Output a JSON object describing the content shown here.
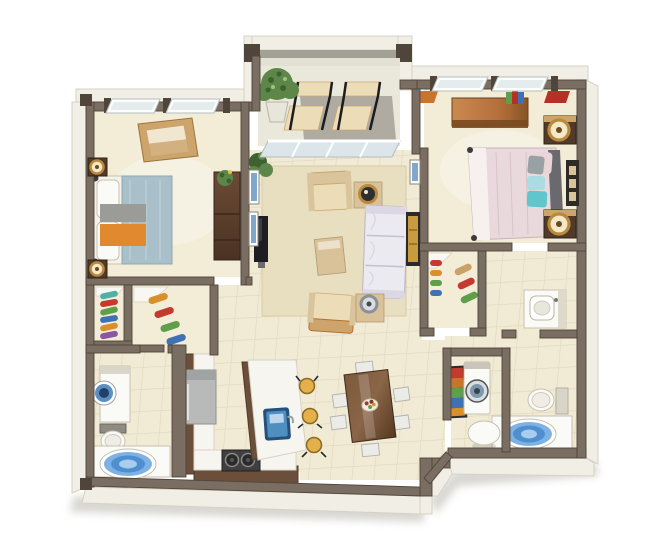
{
  "meta": {
    "kind": "3d-apartment-floor-plan-rendering",
    "background": "#ffffff"
  },
  "palette": {
    "bg": "#ffffff",
    "shadow": "#cdccc6",
    "wallTop": "#7a6d61",
    "wallEdge": "#50453b",
    "outerFace": "#f1eee5",
    "outerEdge": "#d6d1c2",
    "balconyCap": "#a3a096",
    "floorCarpet": "#f3ecd7",
    "floorTile": "#f1ead4",
    "floorTileLine": "#e0d7bb",
    "balconyFloor": "#eae7db",
    "balconyMat": "#a8a49a",
    "glass": "#dce6ea",
    "glassFrame": "#b4bec2",
    "rug": "#e8dec0",
    "wood": "#6b4f3b",
    "woodDark": "#513a29",
    "woodLight": "#cda46c",
    "counter": "#f7f5f0",
    "fridge": "#b7bab9",
    "stove": "#3f3f3f",
    "sinkBlue": "#4f8fc0",
    "sinkBlueDeep": "#24507c",
    "stoolYellow": "#e3b04b",
    "bedBlue": "#a9c0cb",
    "bedBlush": "#ead9dc",
    "headboard": "#6a6a6e",
    "pillowTeal": "#5fc6ce",
    "pillowTealLight": "#a9dde2",
    "pillowGray": "#9aa1a5",
    "throwOrange": "#e0892f",
    "throwGray": "#9b9b97",
    "sofaWhite": "#eceaf1",
    "chairBeige": "#ecdcb8",
    "chairFrame": "#b5702c",
    "tableTan": "#d9c299",
    "walnut": "#6e4c33",
    "chairWhite": "#ebebe7",
    "fixtureWhite": "#fafaf7",
    "fixtureLine": "#c6c1b2",
    "tubBlue1": "#4f8fd0",
    "tubBlue2": "#7fb2e4",
    "tubBlue3": "#a9cdee",
    "plantGreen": "#5d8748",
    "plantDark": "#3f6132",
    "lampGold": "#b98a3e",
    "tvBlack": "#1e1e22",
    "artGold": "#c99a3f",
    "artBlue": "#7fa8cc",
    "artRed": "#b43125",
    "artOrange": "#c9742e",
    "clothesRed": "#c23b2e",
    "clothesGold": "#d98f2b",
    "clothesGreen": "#5f9e4a",
    "clothesBlue": "#3f72b5",
    "clothesTeal": "#4fb0a8",
    "clothesPurple": "#8a56a0"
  },
  "unit": {
    "rooms": [
      {
        "name": "bedroom-2",
        "furniture": [
          "double-bed-blue",
          "nightstand-with-lamp",
          "nightstand-with-lamp",
          "open-storage-chest",
          "wardrobe-with-plant",
          "two-windows"
        ]
      },
      {
        "name": "hall-closets",
        "furniture": [
          "closet-shelf-with-clothes",
          "closet-rod-with-clothes"
        ]
      },
      {
        "name": "bathroom-2",
        "furniture": [
          "basin-cabinet",
          "toilet",
          "round-tub"
        ]
      },
      {
        "name": "balcony",
        "furniture": [
          "potted-tree",
          "patio-chair",
          "patio-chair",
          "floor-mat",
          "sliding-glass-door"
        ]
      },
      {
        "name": "living-room",
        "furniture": [
          "sofa",
          "armchair",
          "armchair",
          "coffee-table",
          "end-table-with-lamp",
          "side-table-with-lamp",
          "tv",
          "area-rug",
          "plant",
          "wall-art"
        ]
      },
      {
        "name": "master-bedroom",
        "furniture": [
          "double-bed-blush",
          "nightstand-with-lamp",
          "nightstand-with-lamp",
          "dresser-with-books",
          "two-windows",
          "wall-art",
          "accent-mats"
        ]
      },
      {
        "name": "master-closet",
        "furniture": [
          "shelf",
          "clothes-on-rods"
        ]
      },
      {
        "name": "master-bathroom",
        "furniture": [
          "vanity-sink",
          "toilet",
          "round-tub"
        ]
      },
      {
        "name": "laundry-closet",
        "furniture": [
          "front-load-washer",
          "artwork-panel"
        ]
      },
      {
        "name": "kitchen",
        "furniture": [
          "refrigerator",
          "l-shaped-counter",
          "cooktop",
          "island-with-sink",
          "bar-stool",
          "bar-stool",
          "bar-stool"
        ]
      },
      {
        "name": "dining-area",
        "furniture": [
          "dining-table",
          "six-chairs",
          "fruit-bowl"
        ]
      },
      {
        "name": "entry",
        "furniture": [
          "open-entry-door",
          "round-side-table"
        ]
      }
    ]
  }
}
